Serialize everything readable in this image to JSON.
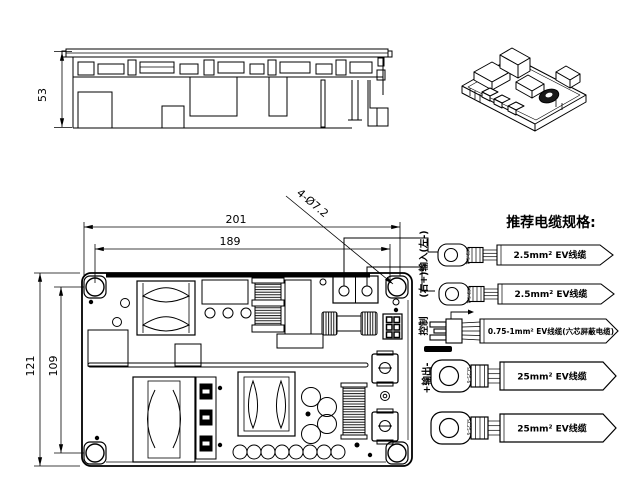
{
  "colors": {
    "line": "#000000",
    "background": "#ffffff"
  },
  "side_view": {
    "height_dim": "53"
  },
  "top_view": {
    "dim_width_outer": "201",
    "dim_width_inner": "189",
    "dim_height_outer": "121",
    "dim_height_inner": "109",
    "hole_callout": "4-Ø7.2"
  },
  "cable_section": {
    "title": "推荐电缆规格:",
    "port_labels": {
      "input": "(右+)输入(左-)",
      "control": "控制",
      "output": "+输出-"
    },
    "cables": [
      {
        "lug": "SC2.5-4",
        "label": "2.5mm² EV线缆"
      },
      {
        "lug": "SC2.5-4",
        "label": "2.5mm² EV线缆"
      },
      {
        "lug": "",
        "label": "0.75-1mm² EV线缆(六芯屏蔽电缆)"
      },
      {
        "lug": "SC25-6",
        "label": "25mm² EV线缆"
      },
      {
        "lug": "SC25-6",
        "label": "25mm² EV线缆"
      }
    ]
  }
}
